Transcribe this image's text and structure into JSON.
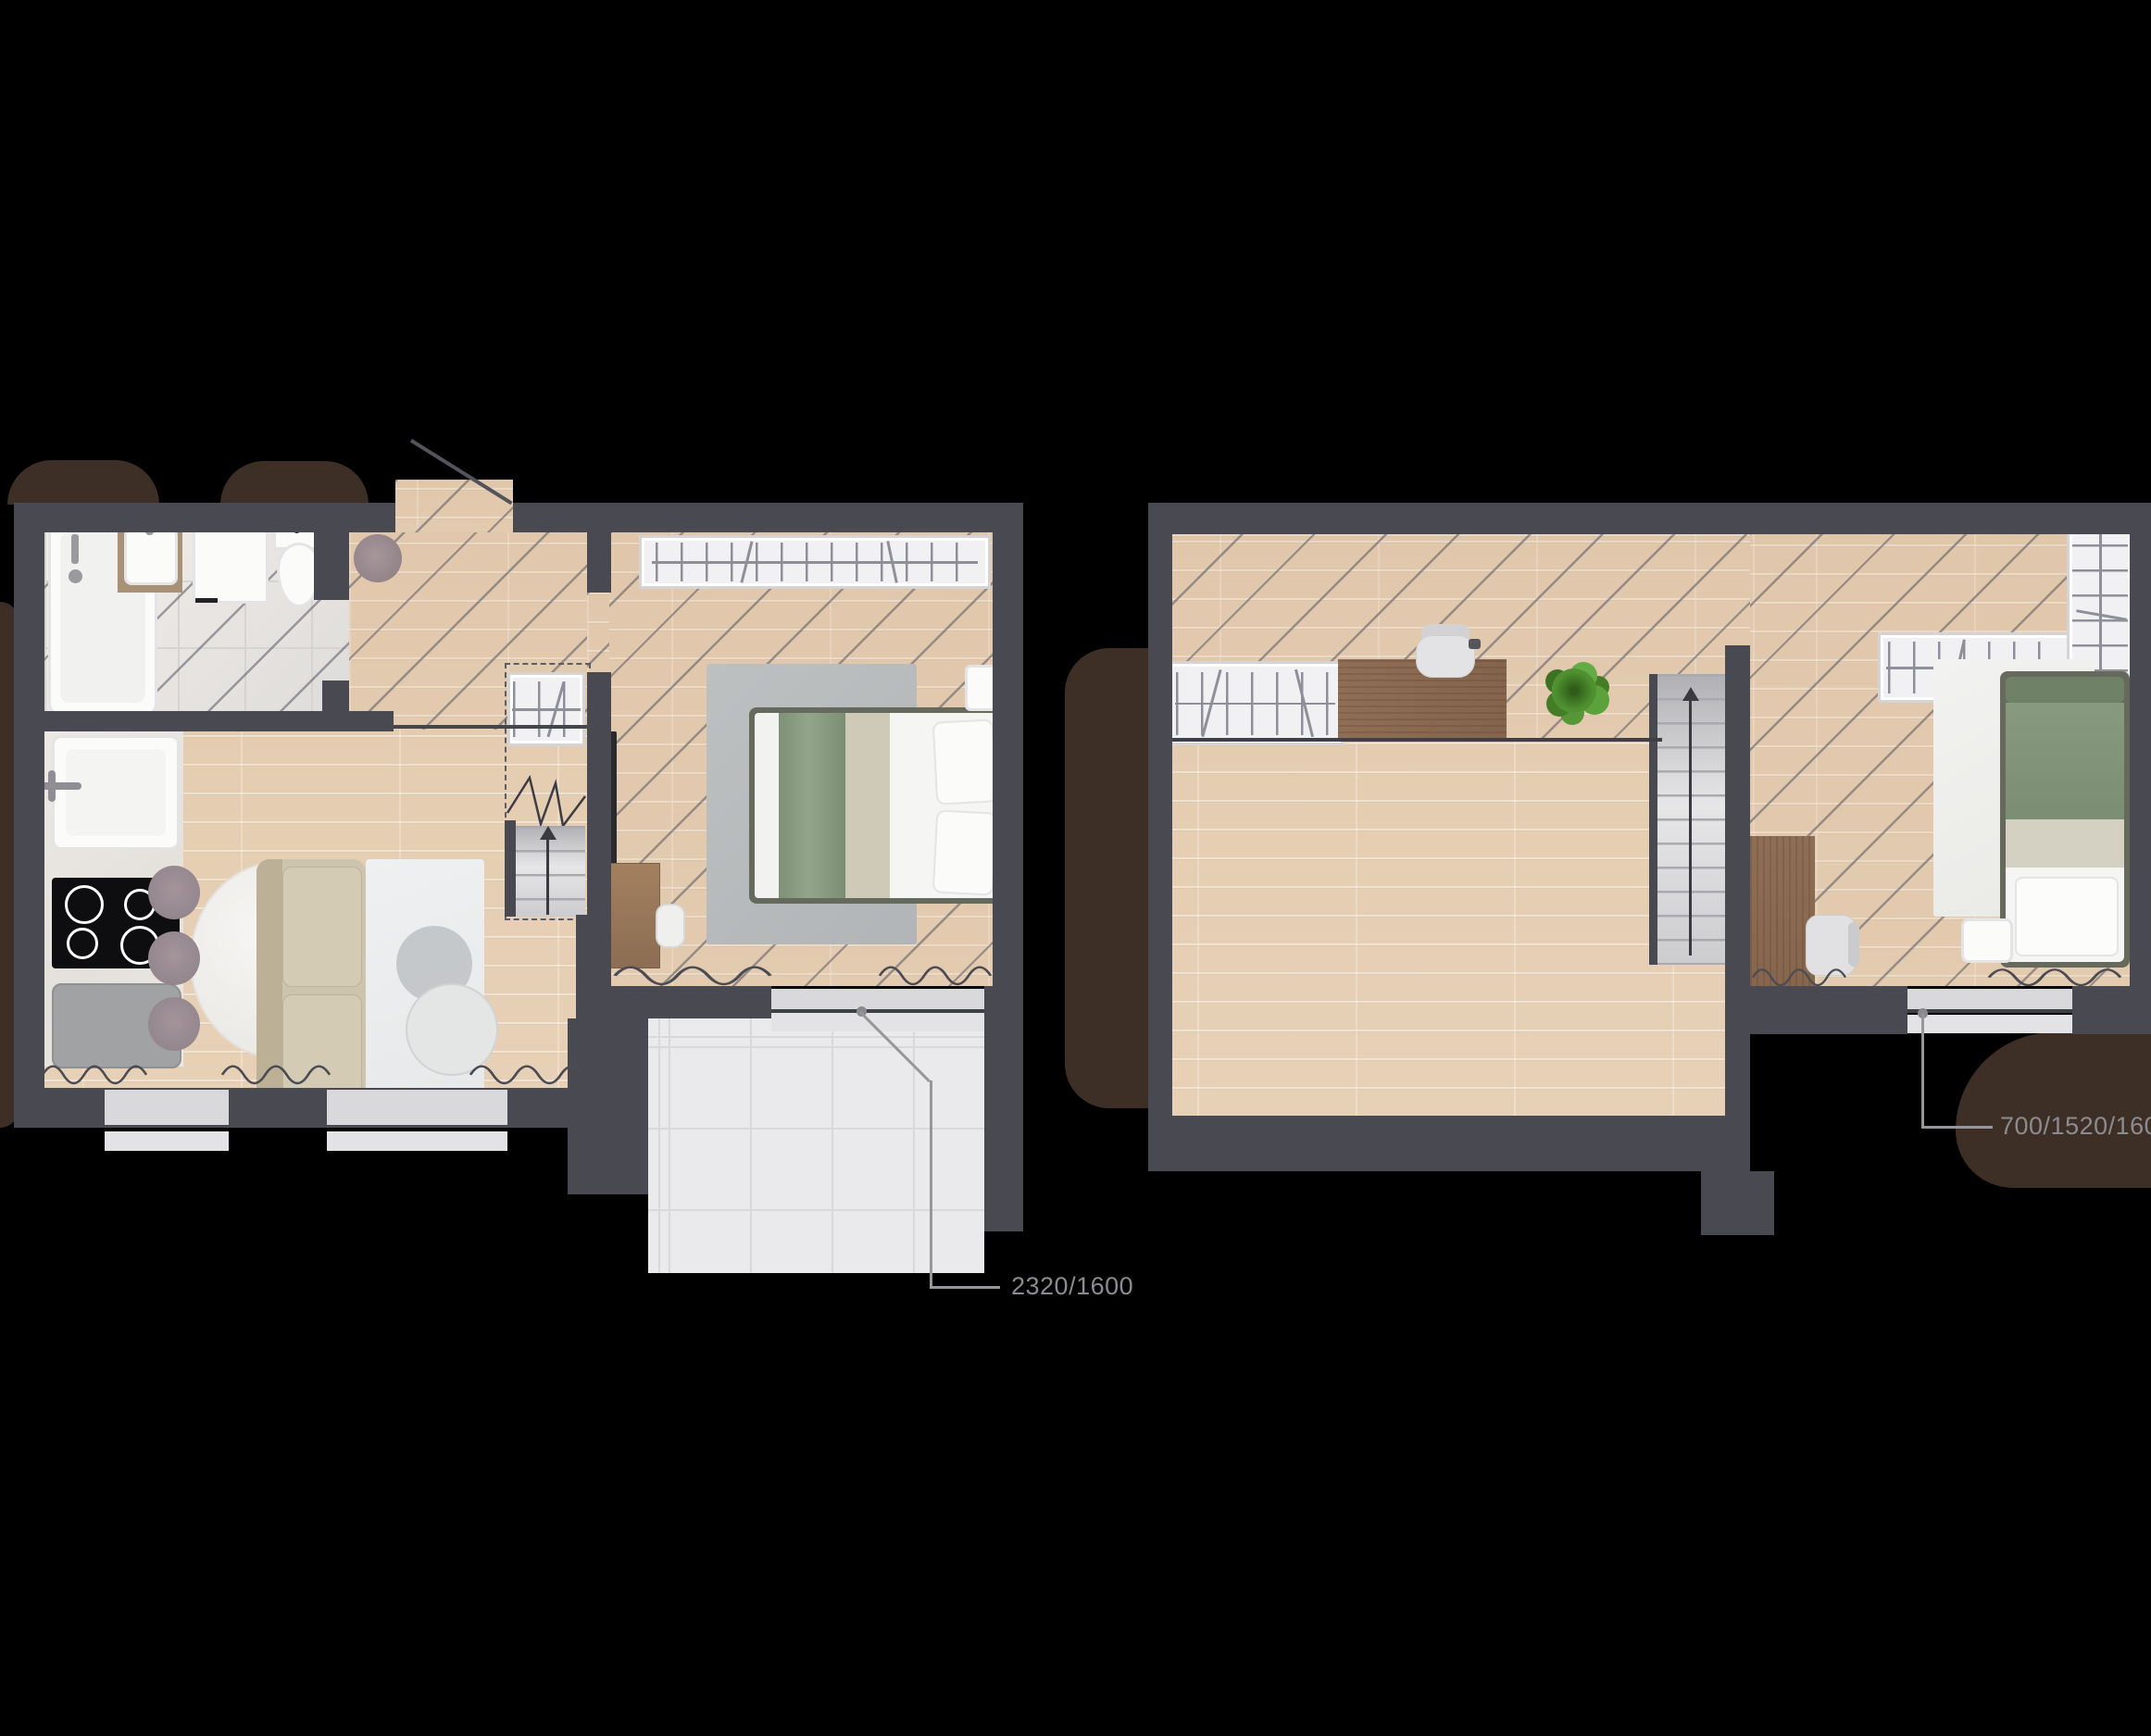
{
  "document": {
    "type": "architectural-floor-plan",
    "view": "top-down furnished plan, two levels side by side on black background"
  },
  "labels": {
    "ground_window_dims": "2320/1600",
    "upper_window_dims": "700/1520/1600"
  },
  "colors": {
    "background": "#000000",
    "wall": "#494951",
    "wood_floor": "#e7d1b7",
    "marble_tile": "#eef0f1",
    "concrete_tile": "#eaeaec",
    "shrub_brown": "#3e2f26",
    "window_glass": "#d9d9db",
    "window_sill": "#e3e3e5",
    "bedding_green": "#87997f",
    "sofa_beige": "#cdc4ad",
    "desk_wood": "#8d6b52",
    "plant_green": "#4f9130",
    "label_text": "#8c8c90",
    "leader_line": "#97979b"
  },
  "floors": [
    {
      "name": "ground floor (left plan)",
      "rooms": [
        "bathroom",
        "hallway",
        "living-room-with-kitchen",
        "bedroom",
        "terrace"
      ],
      "symbols": [
        "bathtub",
        "vanity-sink",
        "washing-machine",
        "toilet",
        "entry-door-swing",
        "round-rug",
        "kitchen-sink",
        "stove-4-burners",
        "fridge",
        "dining-table-oval",
        "dining-chairs-3",
        "sofa",
        "area-rug",
        "side-tables",
        "staircase-up",
        "hall-closet-hangers",
        "wardrobe-hangers",
        "tv",
        "tv-console",
        "stool",
        "double-bed-green-bedding",
        "bedroom-rug",
        "nightstand",
        "terrace-window-2320-1600",
        "facade-windows",
        "shrubs"
      ]
    },
    {
      "name": "upper floor (right plan)",
      "rooms": [
        "open-studio-room",
        "bedroom"
      ],
      "symbols": [
        "wardrobe-hangers",
        "office-desk",
        "office-chair",
        "potted-plant",
        "staircase-up",
        "bedroom-desk",
        "desk-chair",
        "wardrobe-l-shaped-hangers",
        "single-bed-green-bedding",
        "bedroom-rug",
        "nightstand",
        "window-700-1520-1600",
        "shrubs"
      ]
    }
  ]
}
